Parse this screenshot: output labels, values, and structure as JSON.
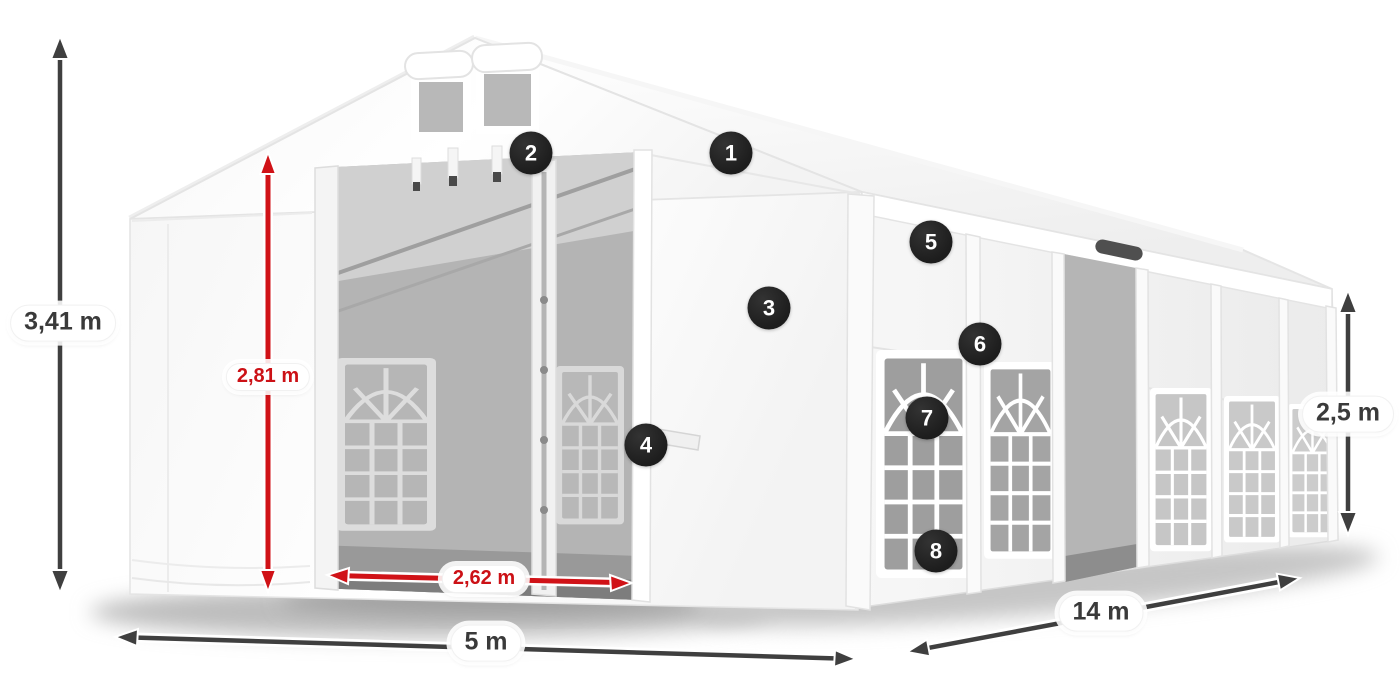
{
  "diagram": {
    "type": "product-dimension-diagram",
    "subject": "white marquee tent with open front entrance, gable roof, arched side windows"
  },
  "colors": {
    "dimension_dark": "#3a3a3a",
    "dimension_red": "#cc1116",
    "arrow_red": "#d01217",
    "arrow_dark": "#3f3f3f",
    "label_background": "#ffffff",
    "badge_background": "#1f1f1f",
    "badge_text": "#ffffff",
    "tent_white": "#ffffff",
    "interior_gray": "#b4b4b4"
  },
  "dimensions": [
    {
      "id": "ridge-height",
      "label": "3,41 m",
      "color_role": "dark",
      "orientation": "vertical"
    },
    {
      "id": "entrance-height",
      "label": "2,81 m",
      "color_role": "red",
      "orientation": "vertical"
    },
    {
      "id": "entrance-width",
      "label": "2,62 m",
      "color_role": "red",
      "orientation": "horizontal"
    },
    {
      "id": "tent-width",
      "label": "5 m",
      "color_role": "dark",
      "orientation": "horizontal"
    },
    {
      "id": "tent-length",
      "label": "14 m",
      "color_role": "dark",
      "orientation": "diagonal"
    },
    {
      "id": "side-height",
      "label": "2,5 m",
      "color_role": "dark",
      "orientation": "vertical"
    }
  ],
  "callouts": [
    {
      "number": "1"
    },
    {
      "number": "2"
    },
    {
      "number": "3"
    },
    {
      "number": "4"
    },
    {
      "number": "5"
    },
    {
      "number": "6"
    },
    {
      "number": "7"
    },
    {
      "number": "8"
    }
  ]
}
